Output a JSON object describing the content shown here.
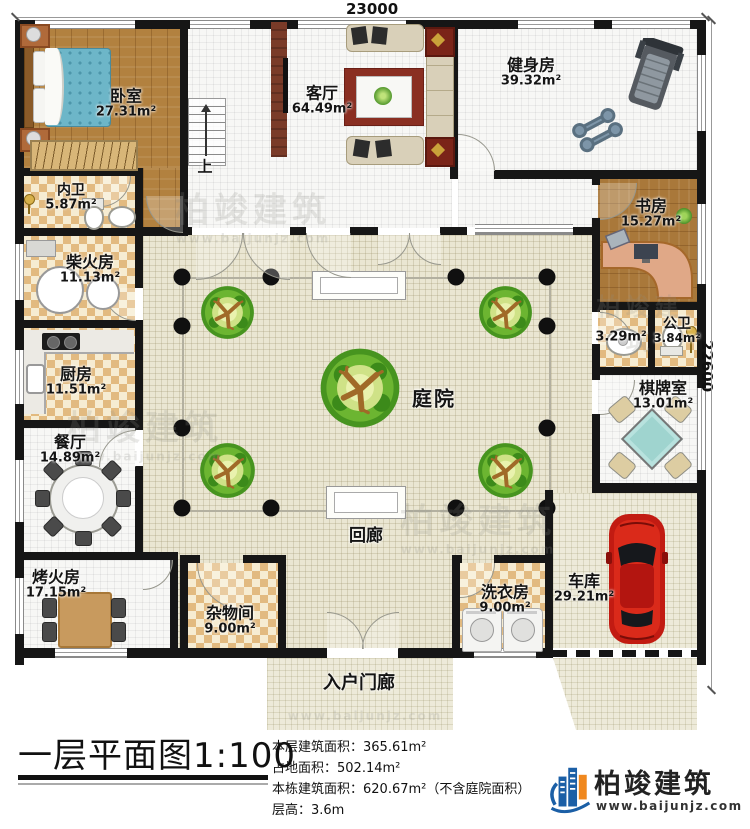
{
  "dimensions": {
    "top": "23000",
    "right": "22600"
  },
  "rooms": {
    "bedroom": {
      "name": "卧室",
      "area": "27.31m²"
    },
    "inner_bath": {
      "name": "内卫",
      "area": "5.87m²"
    },
    "firewood": {
      "name": "柴火房",
      "area": "11.13m²"
    },
    "kitchen": {
      "name": "厨房",
      "area": "11.51m²"
    },
    "dining": {
      "name": "餐厅",
      "area": "14.89m²"
    },
    "heating": {
      "name": "烤火房",
      "area": "17.15m²"
    },
    "living": {
      "name": "客厅",
      "area": "64.49m²"
    },
    "gym": {
      "name": "健身房",
      "area": "39.32m²"
    },
    "study": {
      "name": "书房",
      "area": "15.27m²"
    },
    "washbasin": {
      "area": "3.29m²"
    },
    "public_bath": {
      "name": "公卫",
      "area": "3.84m²"
    },
    "chess": {
      "name": "棋牌室",
      "area": "13.01m²"
    },
    "storage": {
      "name": "杂物间",
      "area": "9.00m²"
    },
    "laundry": {
      "name": "洗衣房",
      "area": "9.00m²"
    },
    "garage": {
      "name": "车库",
      "area": "29.21m²"
    },
    "courtyard": {
      "name": "庭院"
    },
    "corridor": {
      "name": "回廊"
    },
    "porch": {
      "name": "入户门廊"
    },
    "stairs": {
      "up": "上"
    }
  },
  "title": {
    "text": "一层平面图",
    "scale": "1:100"
  },
  "stats": {
    "floor_area": "本层建筑面积：365.61m²",
    "land_area": "占地面积：502.14m²",
    "total_area": "本栋建筑面积：620.67m²（不含庭院面积）",
    "floor_height": "层高：3.6m"
  },
  "brand": {
    "name": "柏竣建筑",
    "website": "www.baijunjz.com"
  },
  "watermark": {
    "text": "柏竣建筑",
    "url": "www.baijunjz.com"
  },
  "colors": {
    "wall": "#161616",
    "brand_blue": "#1b5fa6",
    "brand_orange": "#f0881e",
    "accent_red": "#c02318"
  }
}
